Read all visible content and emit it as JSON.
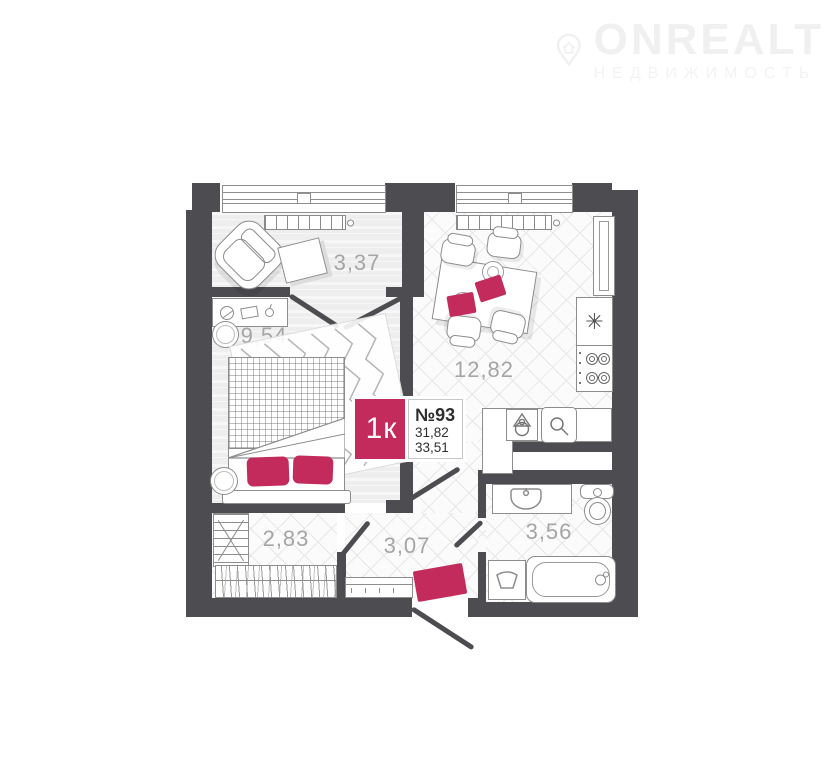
{
  "watermark": {
    "brand": "ONREALT",
    "subtitle": "НЕДВИЖИМОСТЬ"
  },
  "badge": {
    "rooms": "1к",
    "number": "№93",
    "living_area": "31,82",
    "total_area": "33,51"
  },
  "rooms": {
    "loggia": {
      "area": "3,37"
    },
    "bedroom": {
      "area": "9,54"
    },
    "kitchen": {
      "area": "12,82"
    },
    "wardrobe": {
      "area": "2,83"
    },
    "hallway": {
      "area": "3,07"
    },
    "bathroom": {
      "area": "3,56"
    }
  },
  "icons": {
    "fridge": "✳"
  },
  "colors": {
    "accent": "#c22b5b",
    "wall": "#4d4d51"
  }
}
